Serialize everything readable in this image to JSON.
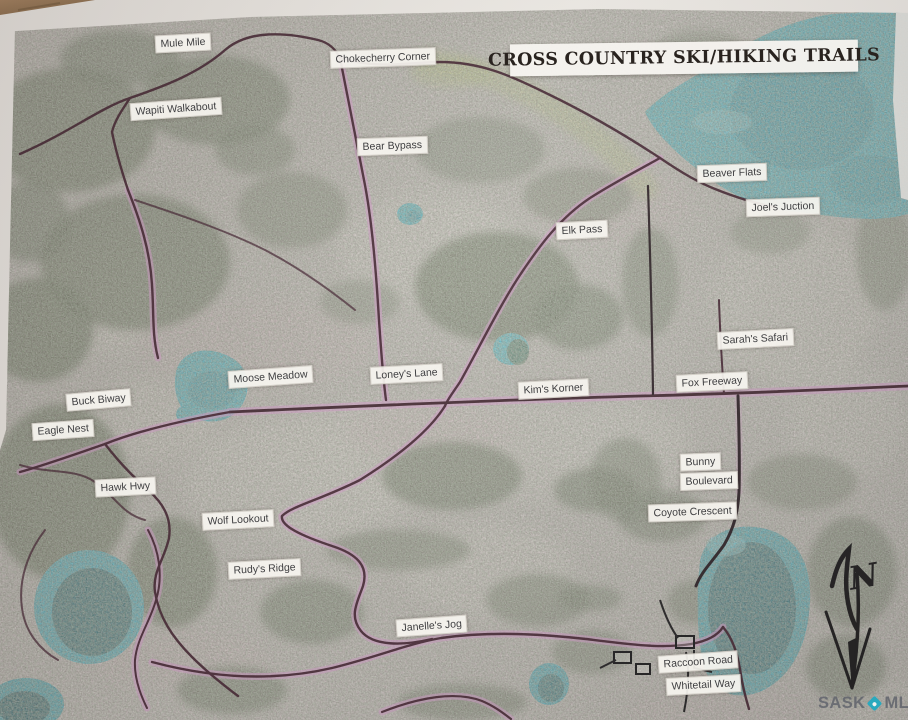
{
  "title": "CROSS COUNTRY SKI/HIKING TRAILS",
  "compass": {
    "label": "N"
  },
  "watermark": {
    "sask": "SASK",
    "mls": "MLS",
    "reg": "®"
  },
  "labels": [
    {
      "id": "mule-mile",
      "text": "Mule Mile",
      "x": 155,
      "y": 34,
      "rot": -3
    },
    {
      "id": "chokecherry-corner",
      "text": "Chokecherry Corner",
      "x": 330,
      "y": 49,
      "rot": -2
    },
    {
      "id": "wapiti-walkabout",
      "text": "Wapiti Walkabout",
      "x": 130,
      "y": 100,
      "rot": -4
    },
    {
      "id": "bear-bypass",
      "text": "Bear Bypass",
      "x": 357,
      "y": 137,
      "rot": -2
    },
    {
      "id": "beaver-flats",
      "text": "Beaver Flats",
      "x": 697,
      "y": 164,
      "rot": -2
    },
    {
      "id": "joels-juction",
      "text": "Joel's Juction",
      "x": 746,
      "y": 198,
      "rot": -2
    },
    {
      "id": "elk-pass",
      "text": "Elk Pass",
      "x": 556,
      "y": 221,
      "rot": -3
    },
    {
      "id": "sarahs-safari",
      "text": "Sarah's Safari",
      "x": 717,
      "y": 330,
      "rot": -3
    },
    {
      "id": "fox-freeway",
      "text": "Fox Freeway",
      "x": 676,
      "y": 373,
      "rot": -3
    },
    {
      "id": "moose-meadow",
      "text": "Moose Meadow",
      "x": 228,
      "y": 368,
      "rot": -4
    },
    {
      "id": "loneys-lane",
      "text": "Loney's Lane",
      "x": 370,
      "y": 365,
      "rot": -3
    },
    {
      "id": "kims-korner",
      "text": "Kim's Korner",
      "x": 518,
      "y": 380,
      "rot": -3
    },
    {
      "id": "buck-biway",
      "text": "Buck Biway",
      "x": 66,
      "y": 391,
      "rot": -5
    },
    {
      "id": "eagle-nest",
      "text": "Eagle Nest",
      "x": 32,
      "y": 421,
      "rot": -4
    },
    {
      "id": "hawk-hwy",
      "text": "Hawk Hwy",
      "x": 95,
      "y": 478,
      "rot": -3
    },
    {
      "id": "bunny",
      "text": "Bunny",
      "x": 680,
      "y": 453,
      "rot": -2
    },
    {
      "id": "boulevard",
      "text": "Boulevard",
      "x": 680,
      "y": 472,
      "rot": -2
    },
    {
      "id": "coyote-crescent",
      "text": "Coyote Crescent",
      "x": 648,
      "y": 503,
      "rot": -2
    },
    {
      "id": "wolf-lookout",
      "text": "Wolf Lookout",
      "x": 202,
      "y": 511,
      "rot": -3
    },
    {
      "id": "rudys-ridge",
      "text": "Rudy's Ridge",
      "x": 228,
      "y": 560,
      "rot": -3
    },
    {
      "id": "janelles-jog",
      "text": "Janelle's Jog",
      "x": 396,
      "y": 617,
      "rot": -4
    },
    {
      "id": "raccoon-road",
      "text": "Raccoon Road",
      "x": 658,
      "y": 653,
      "rot": -4
    },
    {
      "id": "whitetail-way",
      "text": "Whitetail Way",
      "x": 666,
      "y": 676,
      "rot": -3
    }
  ]
}
